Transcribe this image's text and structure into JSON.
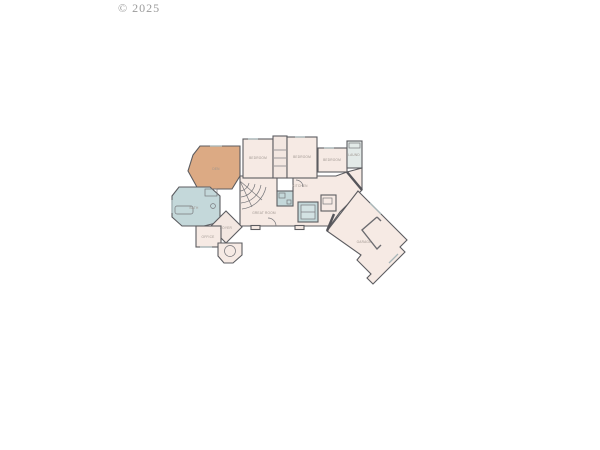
{
  "watermark": {
    "text": "© 2025",
    "color": "#9b9b9b"
  },
  "floor_plan": {
    "type": "residential-floor-plan",
    "colors": {
      "background": "#ffffff",
      "room_fill": "#f6eae4",
      "accent_tan": "#dcaa84",
      "accent_blue": "#c4d8da",
      "accent_blue_light": "#d3e2e3",
      "utility_fill": "#e3eae8",
      "wall": "#5c5c60",
      "label_text": "#9d948e"
    },
    "rooms": [
      {
        "id": "den",
        "label": "DEN"
      },
      {
        "id": "bedroom-2",
        "label": "BEDROOM"
      },
      {
        "id": "bedroom-3",
        "label": "BEDROOM"
      },
      {
        "id": "bedroom-4",
        "label": "BEDROOM"
      },
      {
        "id": "laundry",
        "label": "LAUND"
      },
      {
        "id": "primary-bath",
        "label": "BATH"
      },
      {
        "id": "great-room",
        "label": "GREAT ROOM"
      },
      {
        "id": "kitchen",
        "label": "KITCHEN"
      },
      {
        "id": "foyer",
        "label": "FOYER"
      },
      {
        "id": "office",
        "label": "OFFICE"
      },
      {
        "id": "garage",
        "label": "GARAGE"
      }
    ]
  }
}
